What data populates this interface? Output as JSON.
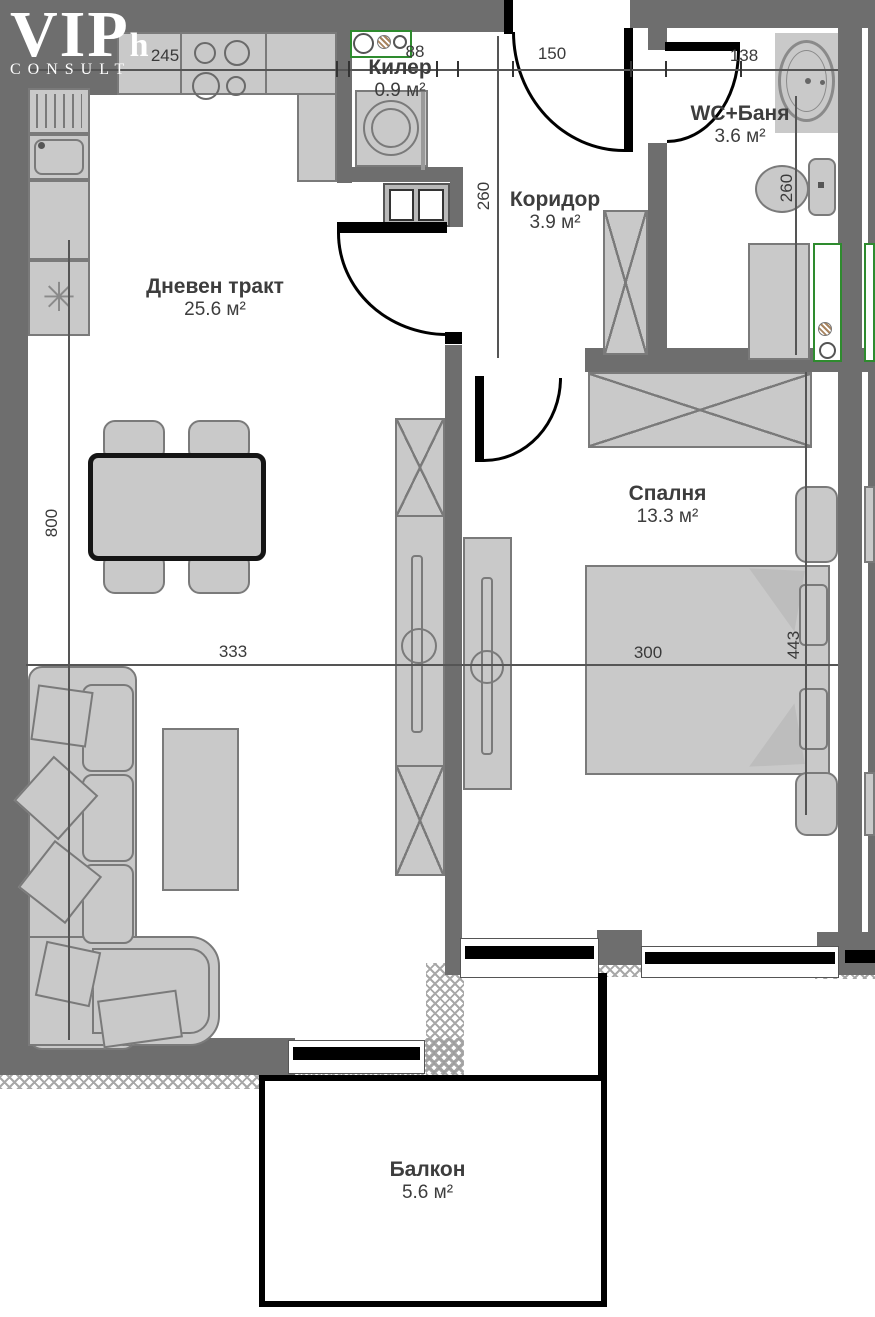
{
  "logo": {
    "main": "VIP",
    "sub": "h",
    "tagline": "CONSULT"
  },
  "rooms": {
    "living": {
      "name": "Дневен тракт",
      "area": "25.6 м²"
    },
    "storage": {
      "name": "Килер",
      "area": "0.9 м²"
    },
    "corridor": {
      "name": "Коридор",
      "area": "3.9 м²"
    },
    "bathroom": {
      "name": "WC+Баня",
      "area": "3.6 м²"
    },
    "bedroom": {
      "name": "Спалня",
      "area": "13.3 м²"
    },
    "balcony": {
      "name": "Балкон",
      "area": "5.6 м²"
    }
  },
  "dimensions": {
    "kitchen_run": "245",
    "storage_width": "88",
    "entrance_opening": "150",
    "bathroom_opening": "138",
    "corridor_depth": "260",
    "bathroom_depth": "260",
    "living_depth": "800",
    "living_width": "333",
    "bedroom_width": "300",
    "bedroom_depth": "443"
  },
  "symbols": {
    "fridge_snowflake": "✳"
  },
  "colors": {
    "wall": "#6e6e6e",
    "furniture_fill": "#c9c9c9",
    "furniture_outline": "#7a7a7a",
    "door_black": "#000000",
    "fixture_green": "#2e8b2e"
  }
}
